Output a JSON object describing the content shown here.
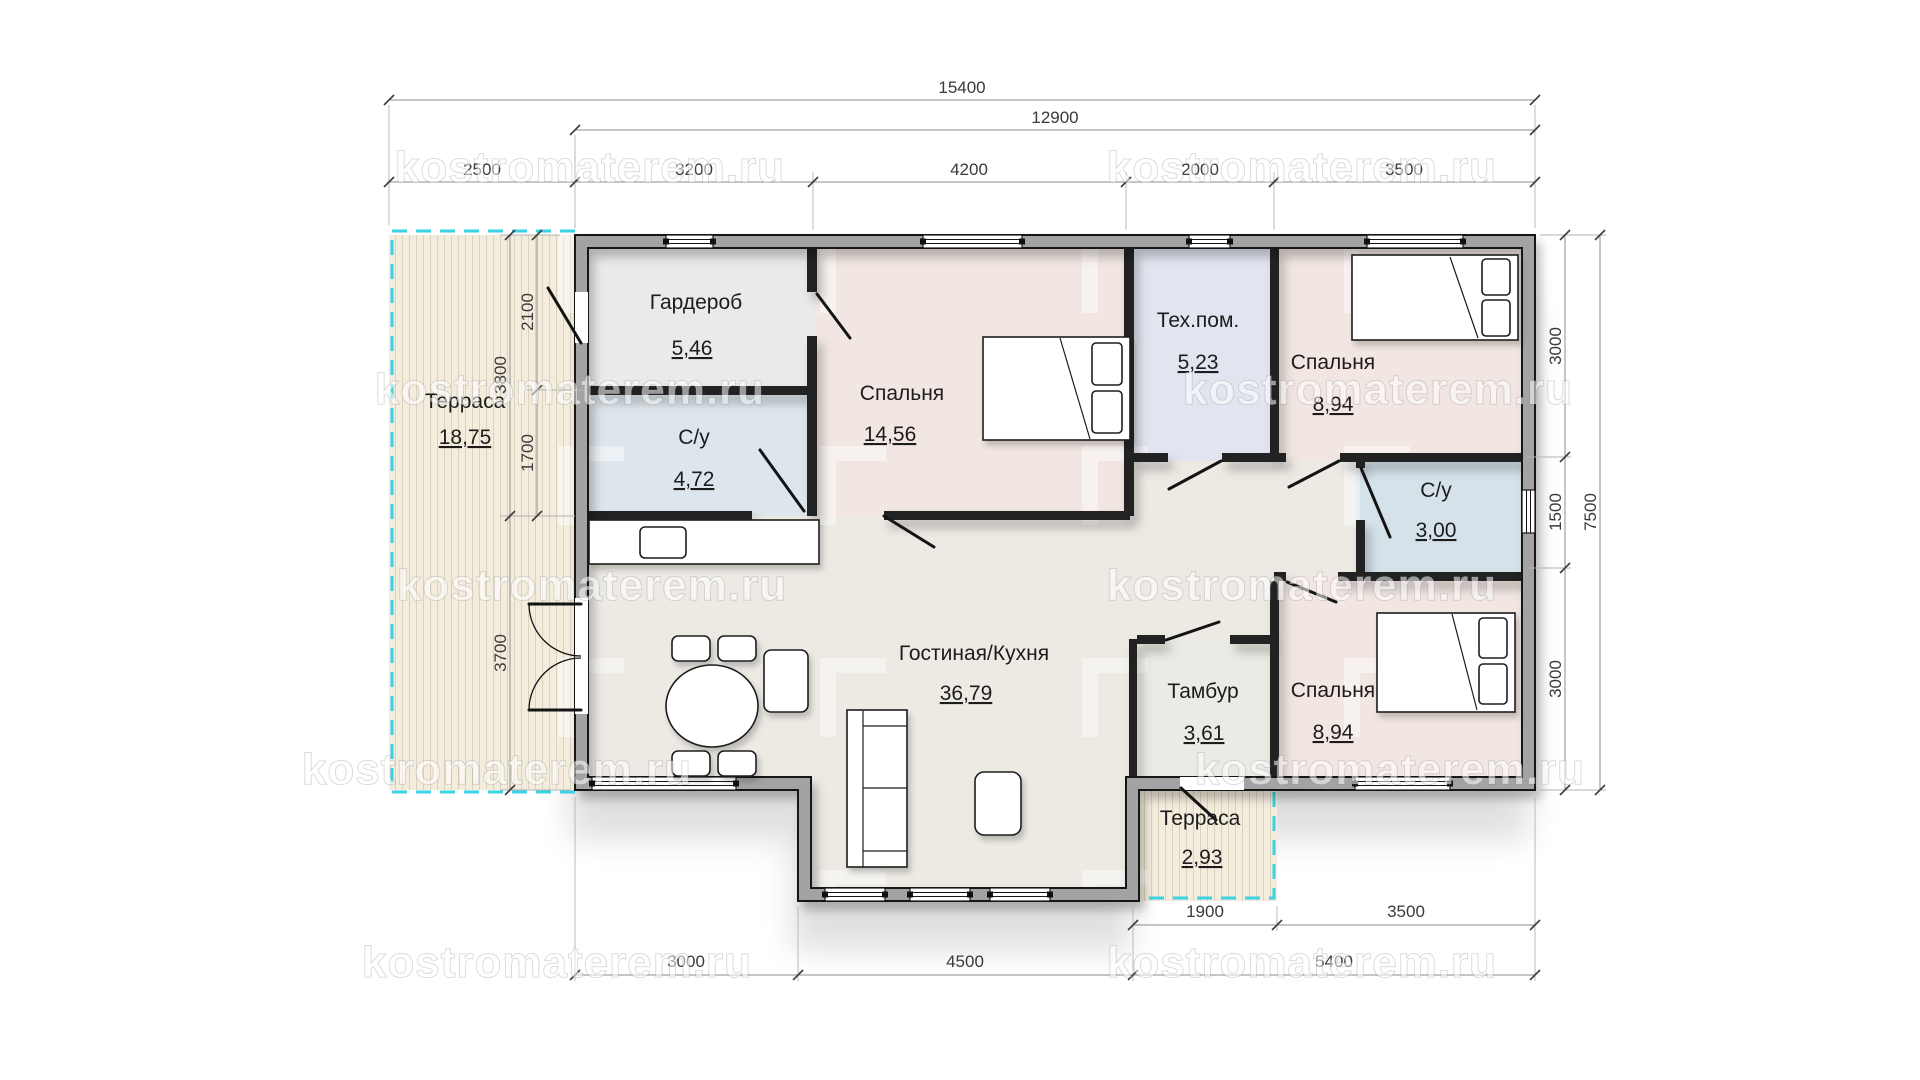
{
  "watermark": {
    "text": "kostromaterem.ru"
  },
  "plan": {
    "rooms": [
      {
        "name": "Терраса",
        "area": "18,75"
      },
      {
        "name": "Гардероб",
        "area": "5,46"
      },
      {
        "name": "С/у",
        "area": "4,72"
      },
      {
        "name": "Спальня",
        "area": "14,56"
      },
      {
        "name": "Тех.пом.",
        "area": "5,23"
      },
      {
        "name": "Спальня",
        "area": "8,94"
      },
      {
        "name": "С/у",
        "area": "3,00"
      },
      {
        "name": "Гостиная/Кухня",
        "area": "36,79"
      },
      {
        "name": "Тамбур",
        "area": "3,61"
      },
      {
        "name": "Спальня",
        "area": "8,94"
      },
      {
        "name": "Терраса",
        "area": "2,93"
      }
    ],
    "dims": {
      "top_total": "15400",
      "top_inner": "12900",
      "top_chain": [
        "2500",
        "3200",
        "4200",
        "2000",
        "3500"
      ],
      "left_inner": [
        "2100",
        "1700"
      ],
      "left_outer": [
        "3800",
        "3700"
      ],
      "right_chain": [
        "3000",
        "1500",
        "3000"
      ],
      "right_total": "7500",
      "bottom_sub": [
        "1900",
        "3500"
      ],
      "bottom_chain": [
        "3000",
        "4500",
        "5400"
      ]
    },
    "colors": {
      "terrace_border": "#3ad2e4",
      "terrace_fill": "#f4eddd",
      "living_fill": "#edeae4",
      "wardrobe_fill": "#eaeaec",
      "bath_fill": "#dde6ec",
      "bath2_fill": "#d5e2ea",
      "bedroom_fill": "#f1e6e1",
      "tech_fill": "#e2e5f0",
      "tambour_fill": "#e9ece4",
      "wall_fill": "#a3a3a3"
    }
  }
}
